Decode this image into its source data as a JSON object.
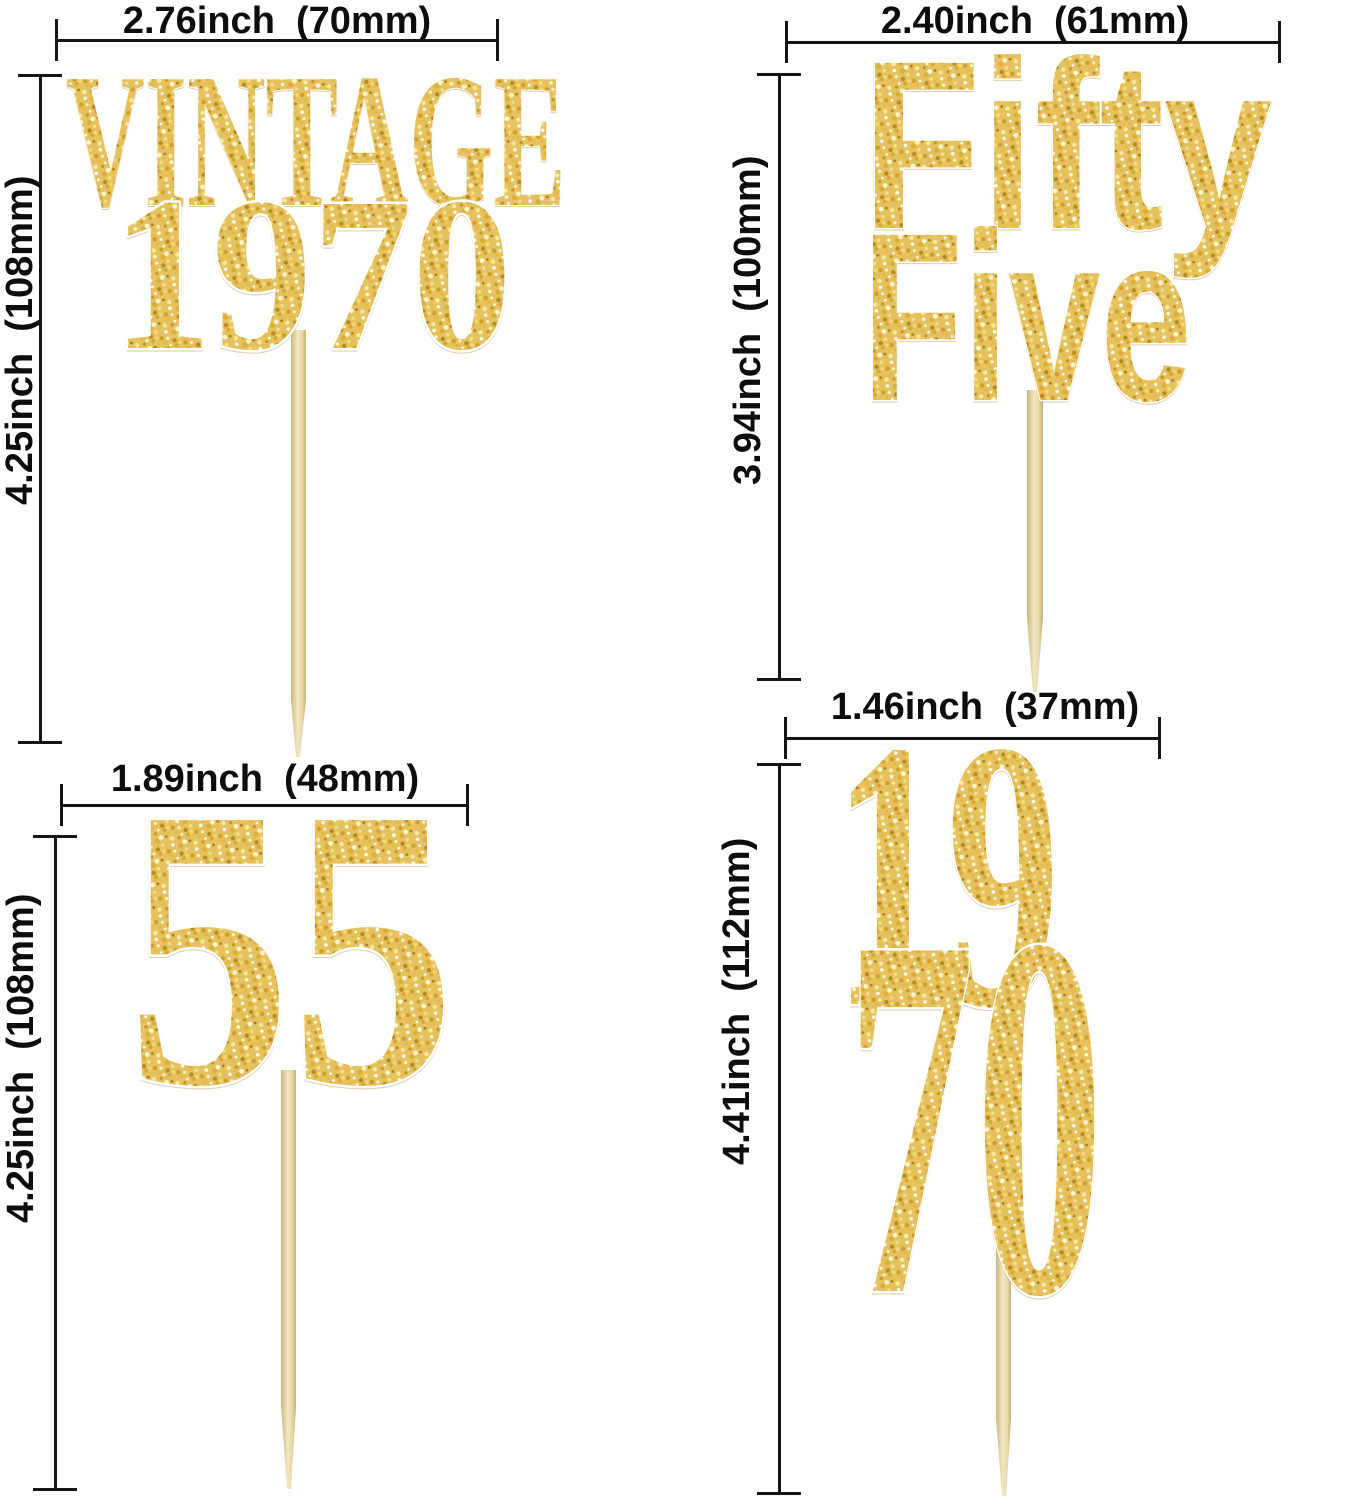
{
  "image_type": "product-dimension-diagram",
  "colors": {
    "dimension_line": "#151515",
    "label_text": "#0d0d0d",
    "glitter_gold_base": "#e6c25f",
    "glitter_gold_light": "#fdf6cf",
    "glitter_gold_dark": "#b68a1e",
    "toothpick": "#e9dcb2",
    "background": "#ffffff"
  },
  "toppers": [
    {
      "name": "vintage-1970",
      "line1": "VINTAGE",
      "line2": "1970",
      "width_label": "2.76inch  (70mm)",
      "height_label": "4.25inch  (108mm)"
    },
    {
      "name": "fifty-five-words",
      "line1": "Fifty",
      "line2": "Five",
      "width_label": "2.40inch  (61mm)",
      "height_label": "3.94inch  (100mm)"
    },
    {
      "name": "fifty-five-numeral",
      "line1": "55",
      "width_label": "1.89inch  (48mm)",
      "height_label": "4.25inch  (108mm)"
    },
    {
      "name": "nineteen-seventy-stacked",
      "line1": "19",
      "line2": "70",
      "width_label": "1.46inch  (37mm)",
      "height_label": "4.41inch  (112mm)"
    }
  ]
}
